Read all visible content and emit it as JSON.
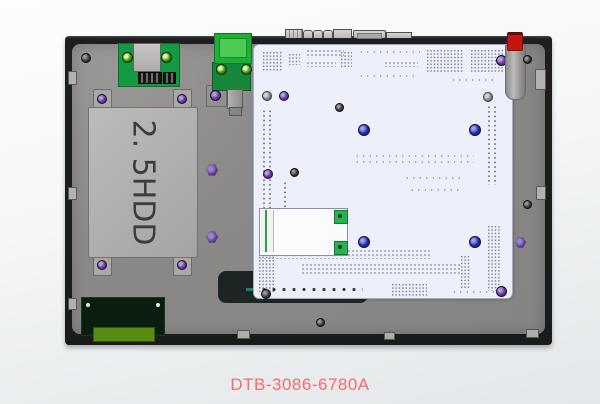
{
  "device": {
    "hdd_label": "2. 5HDD",
    "part_number": "DTB-3086-6780A"
  },
  "colors": {
    "caption_red": "#f96a6a",
    "chassis_gray": "#8b8987",
    "frame_dark": "#1e1e1e",
    "board_white": "#edeffa",
    "pcb_green": "#159a43",
    "bright_connector_green": "#1fae36",
    "io_board_dark_green": "#0b1d0e",
    "olive_connector_green": "#588c12",
    "hdd_bracket_gray": "#b2b1af",
    "red_cap": "#c6140e",
    "screw_purple": "#6a3fa0",
    "screw_blue": "#2b2f9e"
  }
}
